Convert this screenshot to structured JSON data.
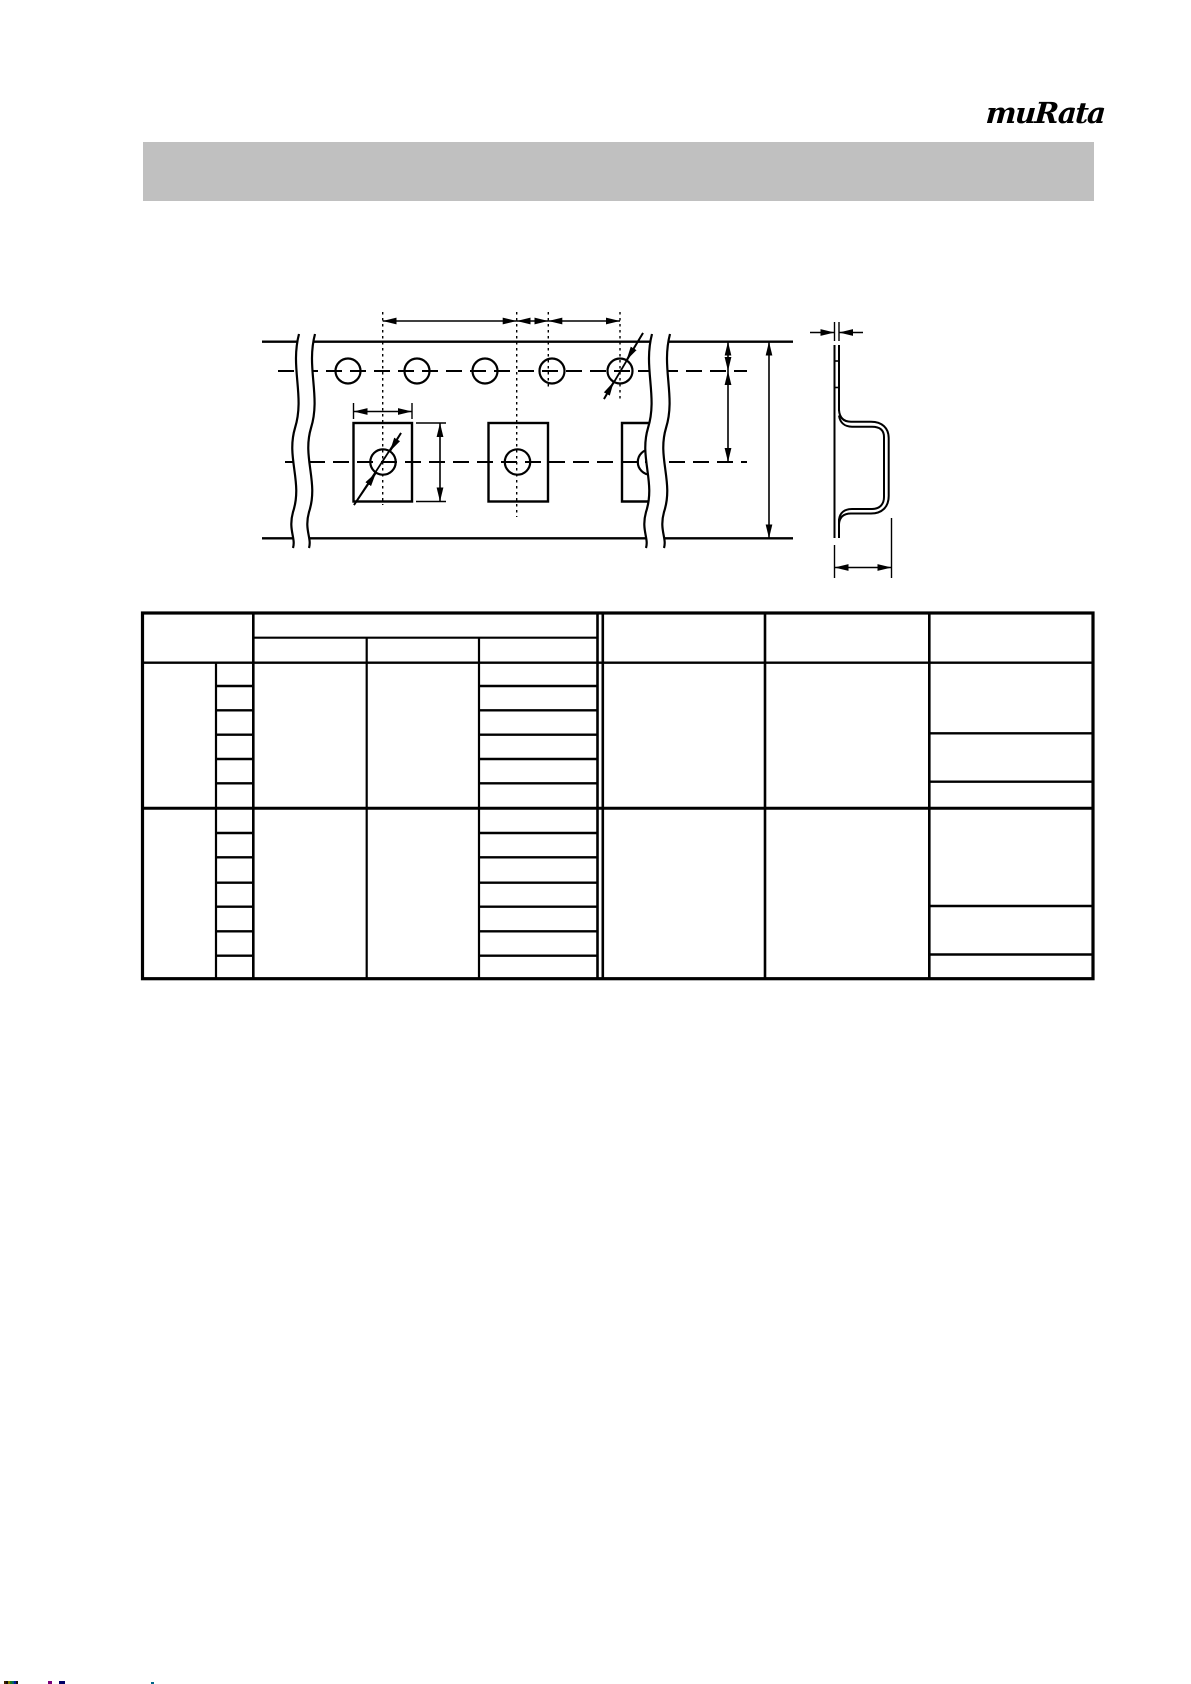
{
  "page": {
    "width_px": 1191,
    "height_px": 1684,
    "background_color": "#ffffff"
  },
  "header": {
    "logo_text": "muRata",
    "title_bar_text": "",
    "title_bar_color": "#c0c0c0"
  },
  "diagram": {
    "description": "Carrier tape packaging dimensions drawing (no text labels rendered)",
    "views": [
      {
        "name": "tape-top-view",
        "sprocket_hole_count": 5,
        "cavity_count": 3,
        "features": [
          "sprocket-hole-pitch-dimension-chain",
          "cavity-width-dimension",
          "cavity-length-dimension",
          "sprocket-hole-diameter-mark",
          "cavity-hole-diameter-mark",
          "tape-width-dimension",
          "edge-to-hole-center-dimension",
          "hole-center-to-cavity-center-dimension",
          "wavy-break-lines"
        ]
      },
      {
        "name": "tape-cross-section-view",
        "features": [
          "tape-thickness-dimension",
          "emboss-cavity-profile",
          "emboss-depth-dimension"
        ]
      }
    ]
  },
  "table": {
    "title": "",
    "all_cells_text": "",
    "header_rows": 2,
    "left_columns": 2,
    "sub_columns_under_merged_header": 3,
    "right_columns": 3,
    "row_groups": [
      {
        "small_rows": 6,
        "right_column_cells": 3
      },
      {
        "small_rows": 7,
        "right_column_cells": 3
      }
    ]
  },
  "footer": {
    "stripe_colors": [
      "#402000",
      "#101010",
      "#808000",
      "#1a7a1a",
      "#006666",
      "#001a99",
      "#101010"
    ],
    "dot_colors": [
      "#7a007a",
      "#000066",
      "#006688"
    ]
  }
}
